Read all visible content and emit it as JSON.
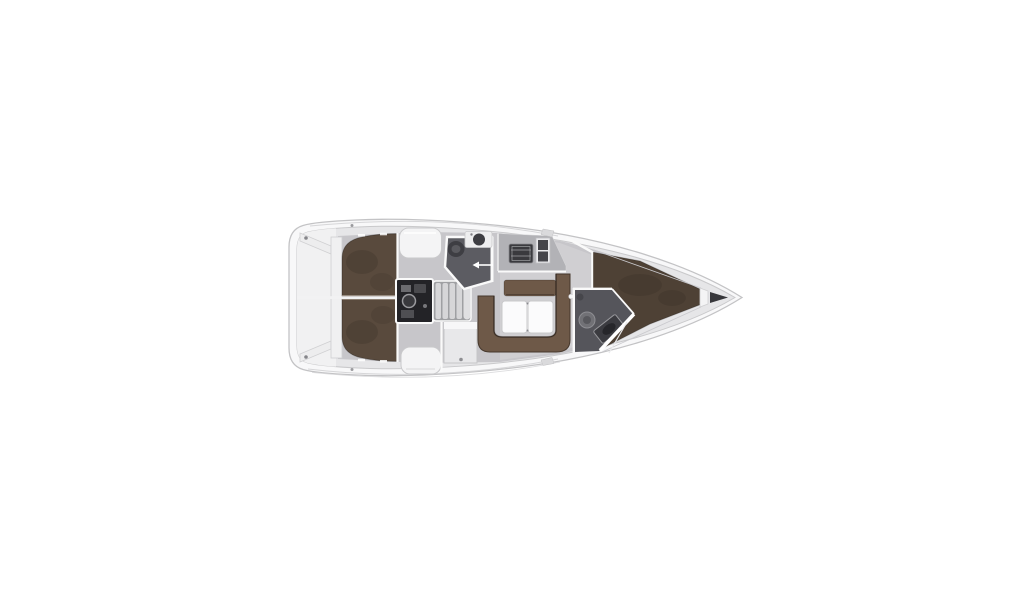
{
  "colors": {
    "background": "#ffffff",
    "hull": "#f8f8f9",
    "hull_outline": "#c3c3c5",
    "deck_lining": "#e6e6e8",
    "lining_edge": "#c9c9cb",
    "transom_panel": "#f1f1f2",
    "floor": "#c7c6ca",
    "berth_aft": "#594a3d",
    "berth_fore": "#4e4135",
    "sofa": "#6e5948",
    "sofa_outline": "#46382d",
    "table": "#fbfbfc",
    "pad": "#f4f4f5",
    "cabinet": "#e8e8ea",
    "counter": "#b2b2b6",
    "stove": "#3a3a3e",
    "sink": "#46464b",
    "head_floor": "#5c5c62",
    "head_floor_aft": "#55555b",
    "fixture_dark": "#3e3e43",
    "fixture_light": "#717176",
    "engine": "#232327",
    "steps": "#d6d6d8",
    "steps_base": "#9fa0a3",
    "wall": "#fafafa",
    "anchor_locker": "#37373b",
    "detail_line": "#d6d6d8",
    "cleat": "#85858a"
  }
}
